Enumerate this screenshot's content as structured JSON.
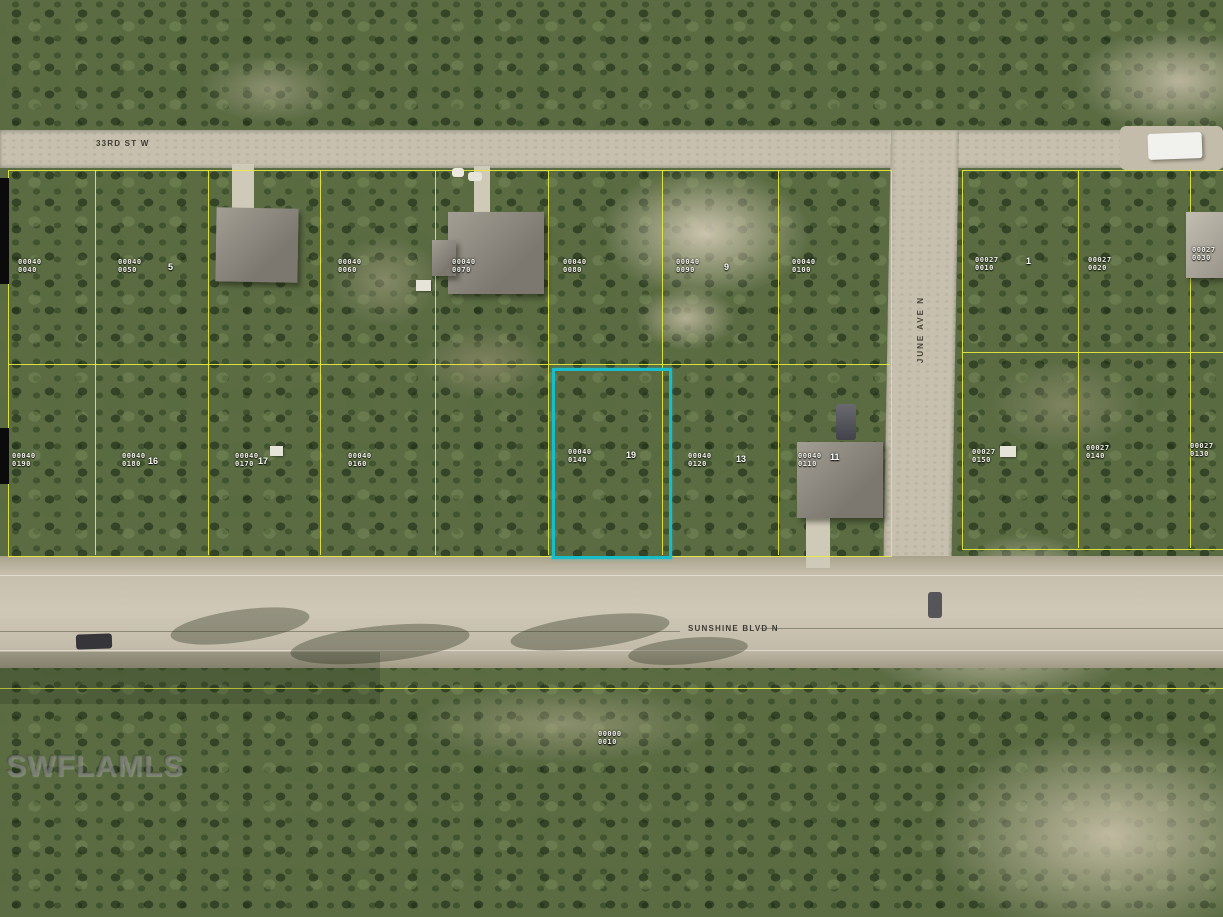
{
  "watermark": {
    "text": "SWFLAMLS"
  },
  "streets": {
    "top_street": "33RD ST W",
    "main_street": "SUNSHINE BLVD N",
    "side_street": "JUNE AVE N"
  },
  "highlight": {
    "border_color": "#17bdc8",
    "parcel_block": "00040",
    "parcel_lot": "0140"
  },
  "colors": {
    "parcel_line": "#e9ec3e",
    "road": "#c7c0ae",
    "vegetation": "#5b6c43",
    "sand": "#cdc5ab",
    "highlight": "#17bdc8"
  },
  "parcel_labels": [
    {
      "block": "00040",
      "lot": "0040"
    },
    {
      "block": "00040",
      "lot": "0050"
    },
    {
      "block": "00040",
      "lot": "0060"
    },
    {
      "block": "00040",
      "lot": "0070"
    },
    {
      "block": "00040",
      "lot": "0080"
    },
    {
      "block": "00040",
      "lot": "0090"
    },
    {
      "block": "00040",
      "lot": "0100"
    },
    {
      "block": "00040",
      "lot": "0190"
    },
    {
      "block": "00040",
      "lot": "0180"
    },
    {
      "block": "00040",
      "lot": "0170"
    },
    {
      "block": "00040",
      "lot": "0160"
    },
    {
      "block": "00040",
      "lot": "0140"
    },
    {
      "block": "00040",
      "lot": "0120"
    },
    {
      "block": "00040",
      "lot": "0110"
    },
    {
      "block": "00027",
      "lot": "0010"
    },
    {
      "block": "00027",
      "lot": "0020"
    },
    {
      "block": "00027",
      "lot": "0030"
    },
    {
      "block": "00027",
      "lot": "0150"
    },
    {
      "block": "00027",
      "lot": "0140"
    },
    {
      "block": "00027",
      "lot": "0130"
    },
    {
      "block": "00000",
      "lot": "0010"
    }
  ],
  "lot_numbers": [
    {
      "value": "5"
    },
    {
      "value": "9"
    },
    {
      "value": "16"
    },
    {
      "value": "17"
    },
    {
      "value": "19"
    },
    {
      "value": "13"
    },
    {
      "value": "11"
    },
    {
      "value": "1"
    }
  ]
}
